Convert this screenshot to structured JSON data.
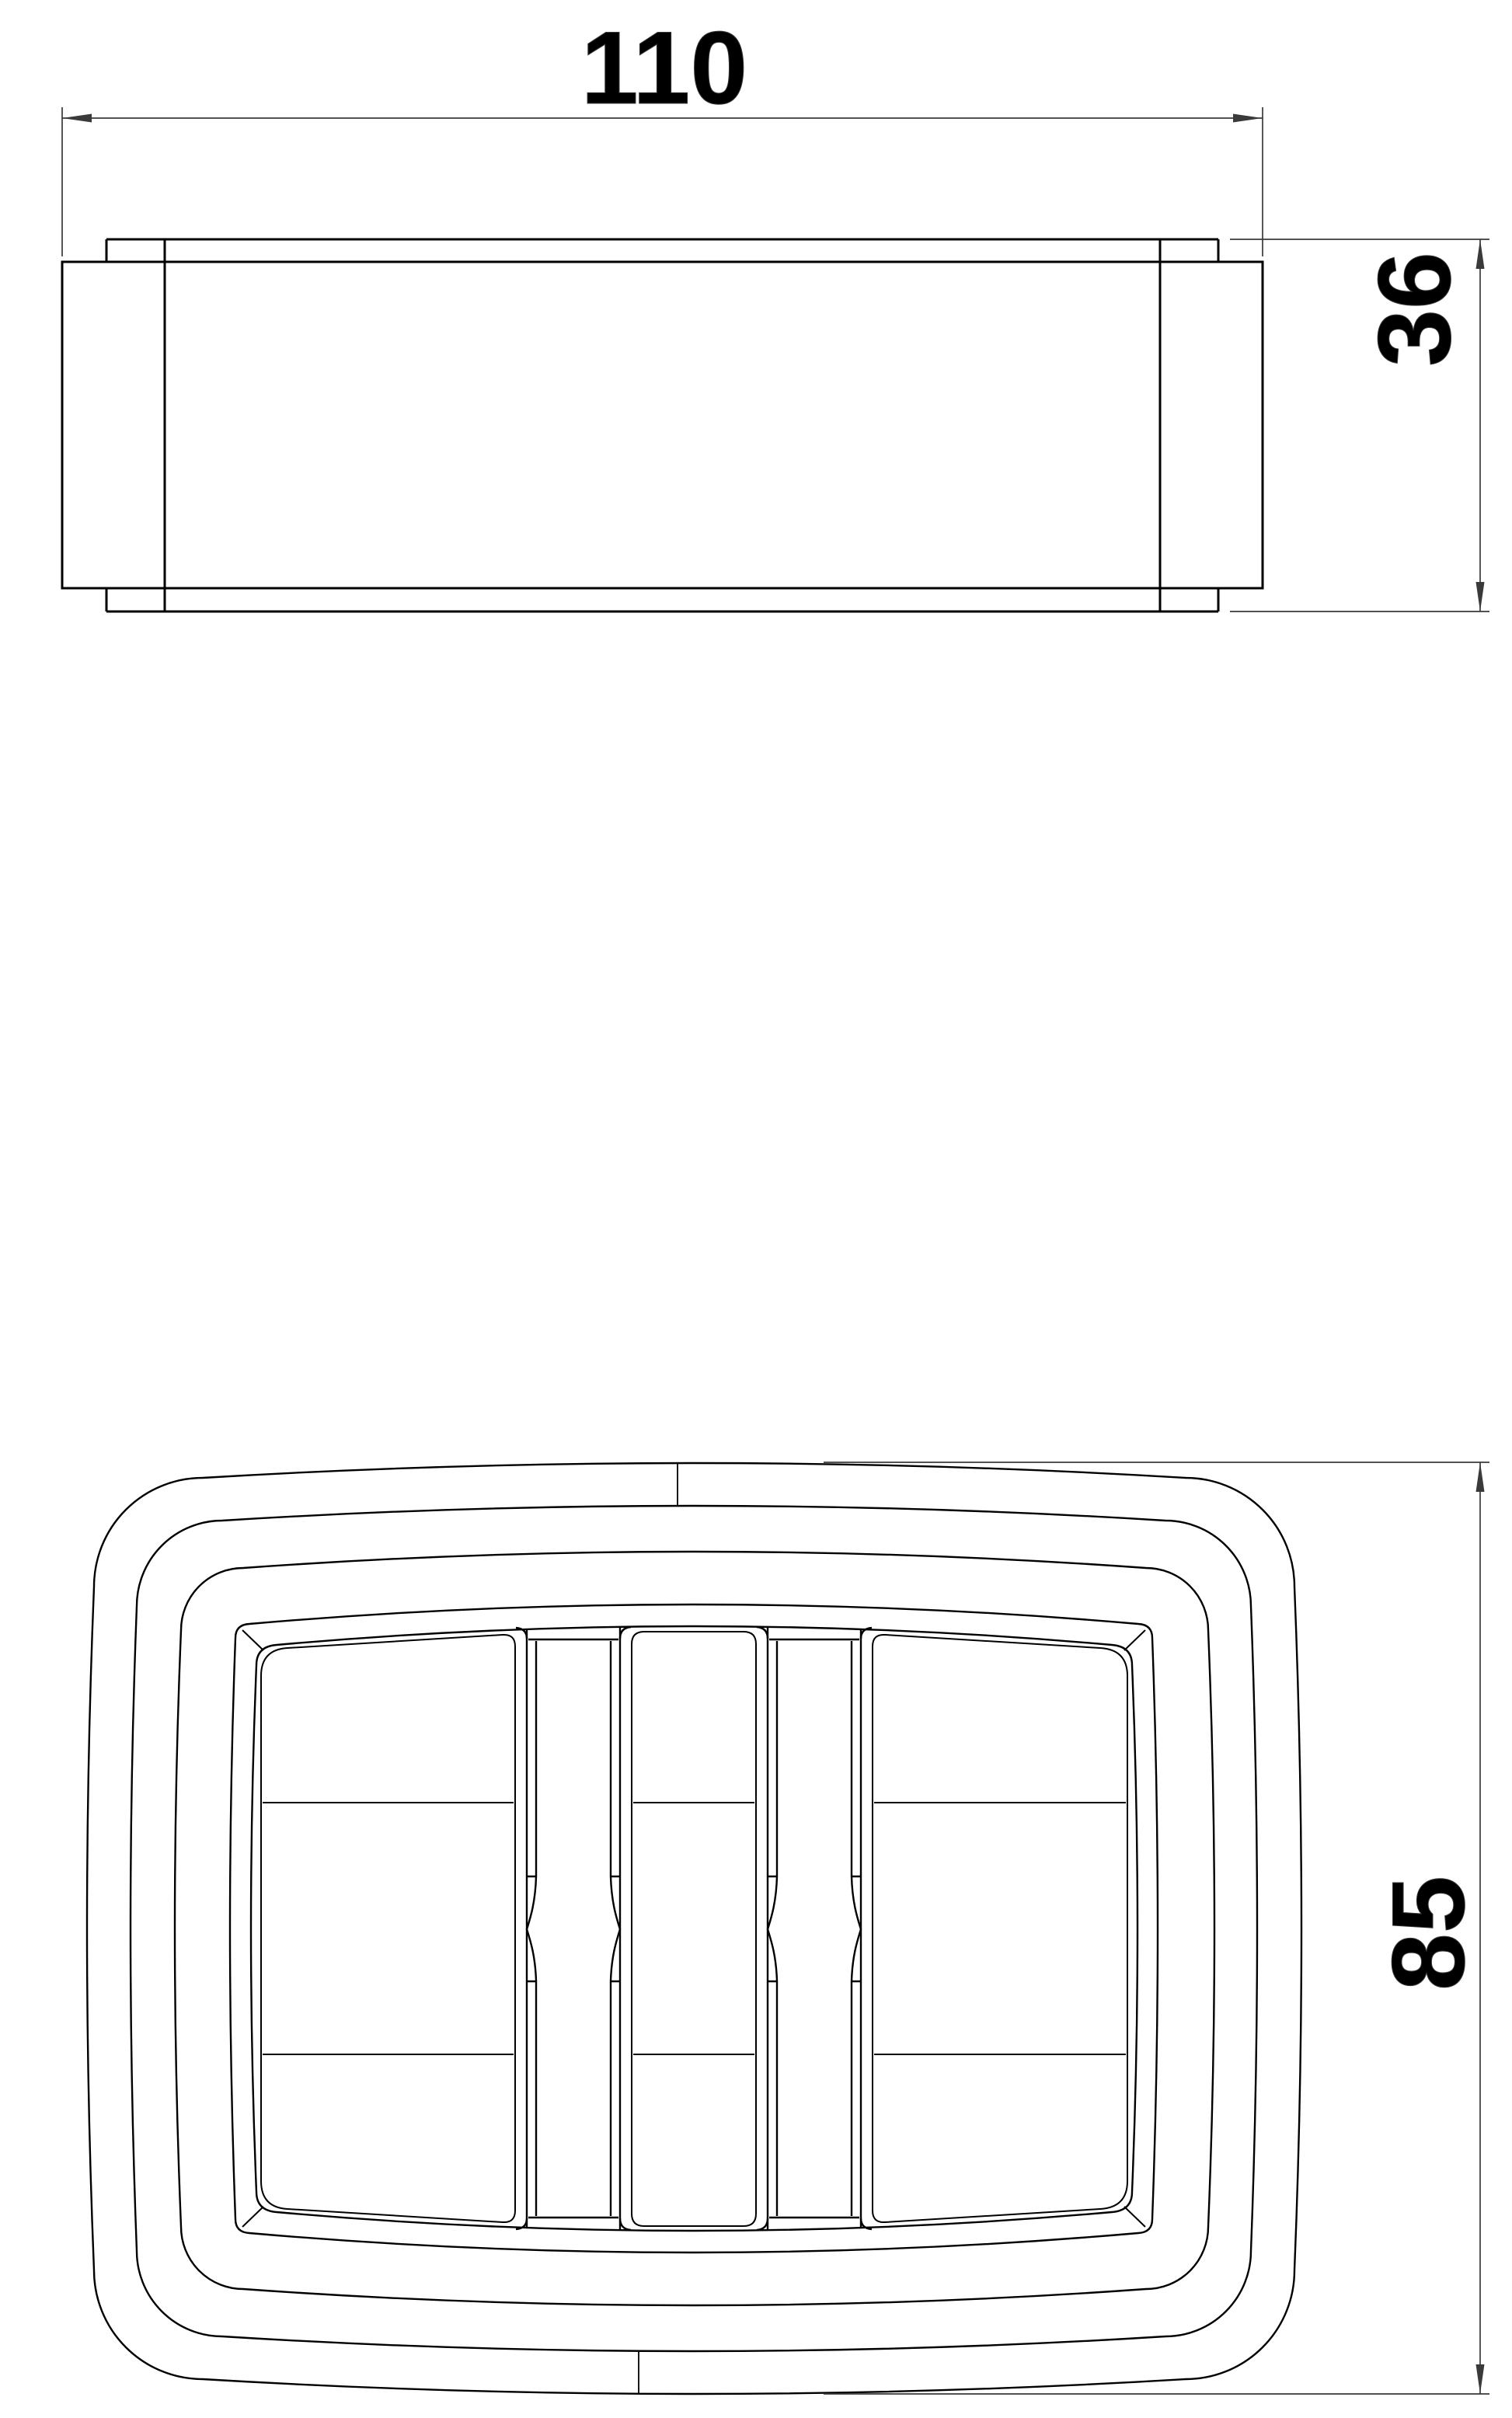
{
  "document": {
    "type": "technical-drawing",
    "background": "#ffffff"
  },
  "colors": {
    "part_line": "#000000",
    "dim_line": "#3a3a3a",
    "label_text": "#000000"
  },
  "views": {
    "side": {
      "title": "side-elevation-view",
      "dimensions": {
        "width": {
          "label": "110"
        },
        "height": {
          "label": "36"
        }
      }
    },
    "plan": {
      "title": "plan-view",
      "dimensions": {
        "height": {
          "label": "85"
        }
      }
    }
  }
}
